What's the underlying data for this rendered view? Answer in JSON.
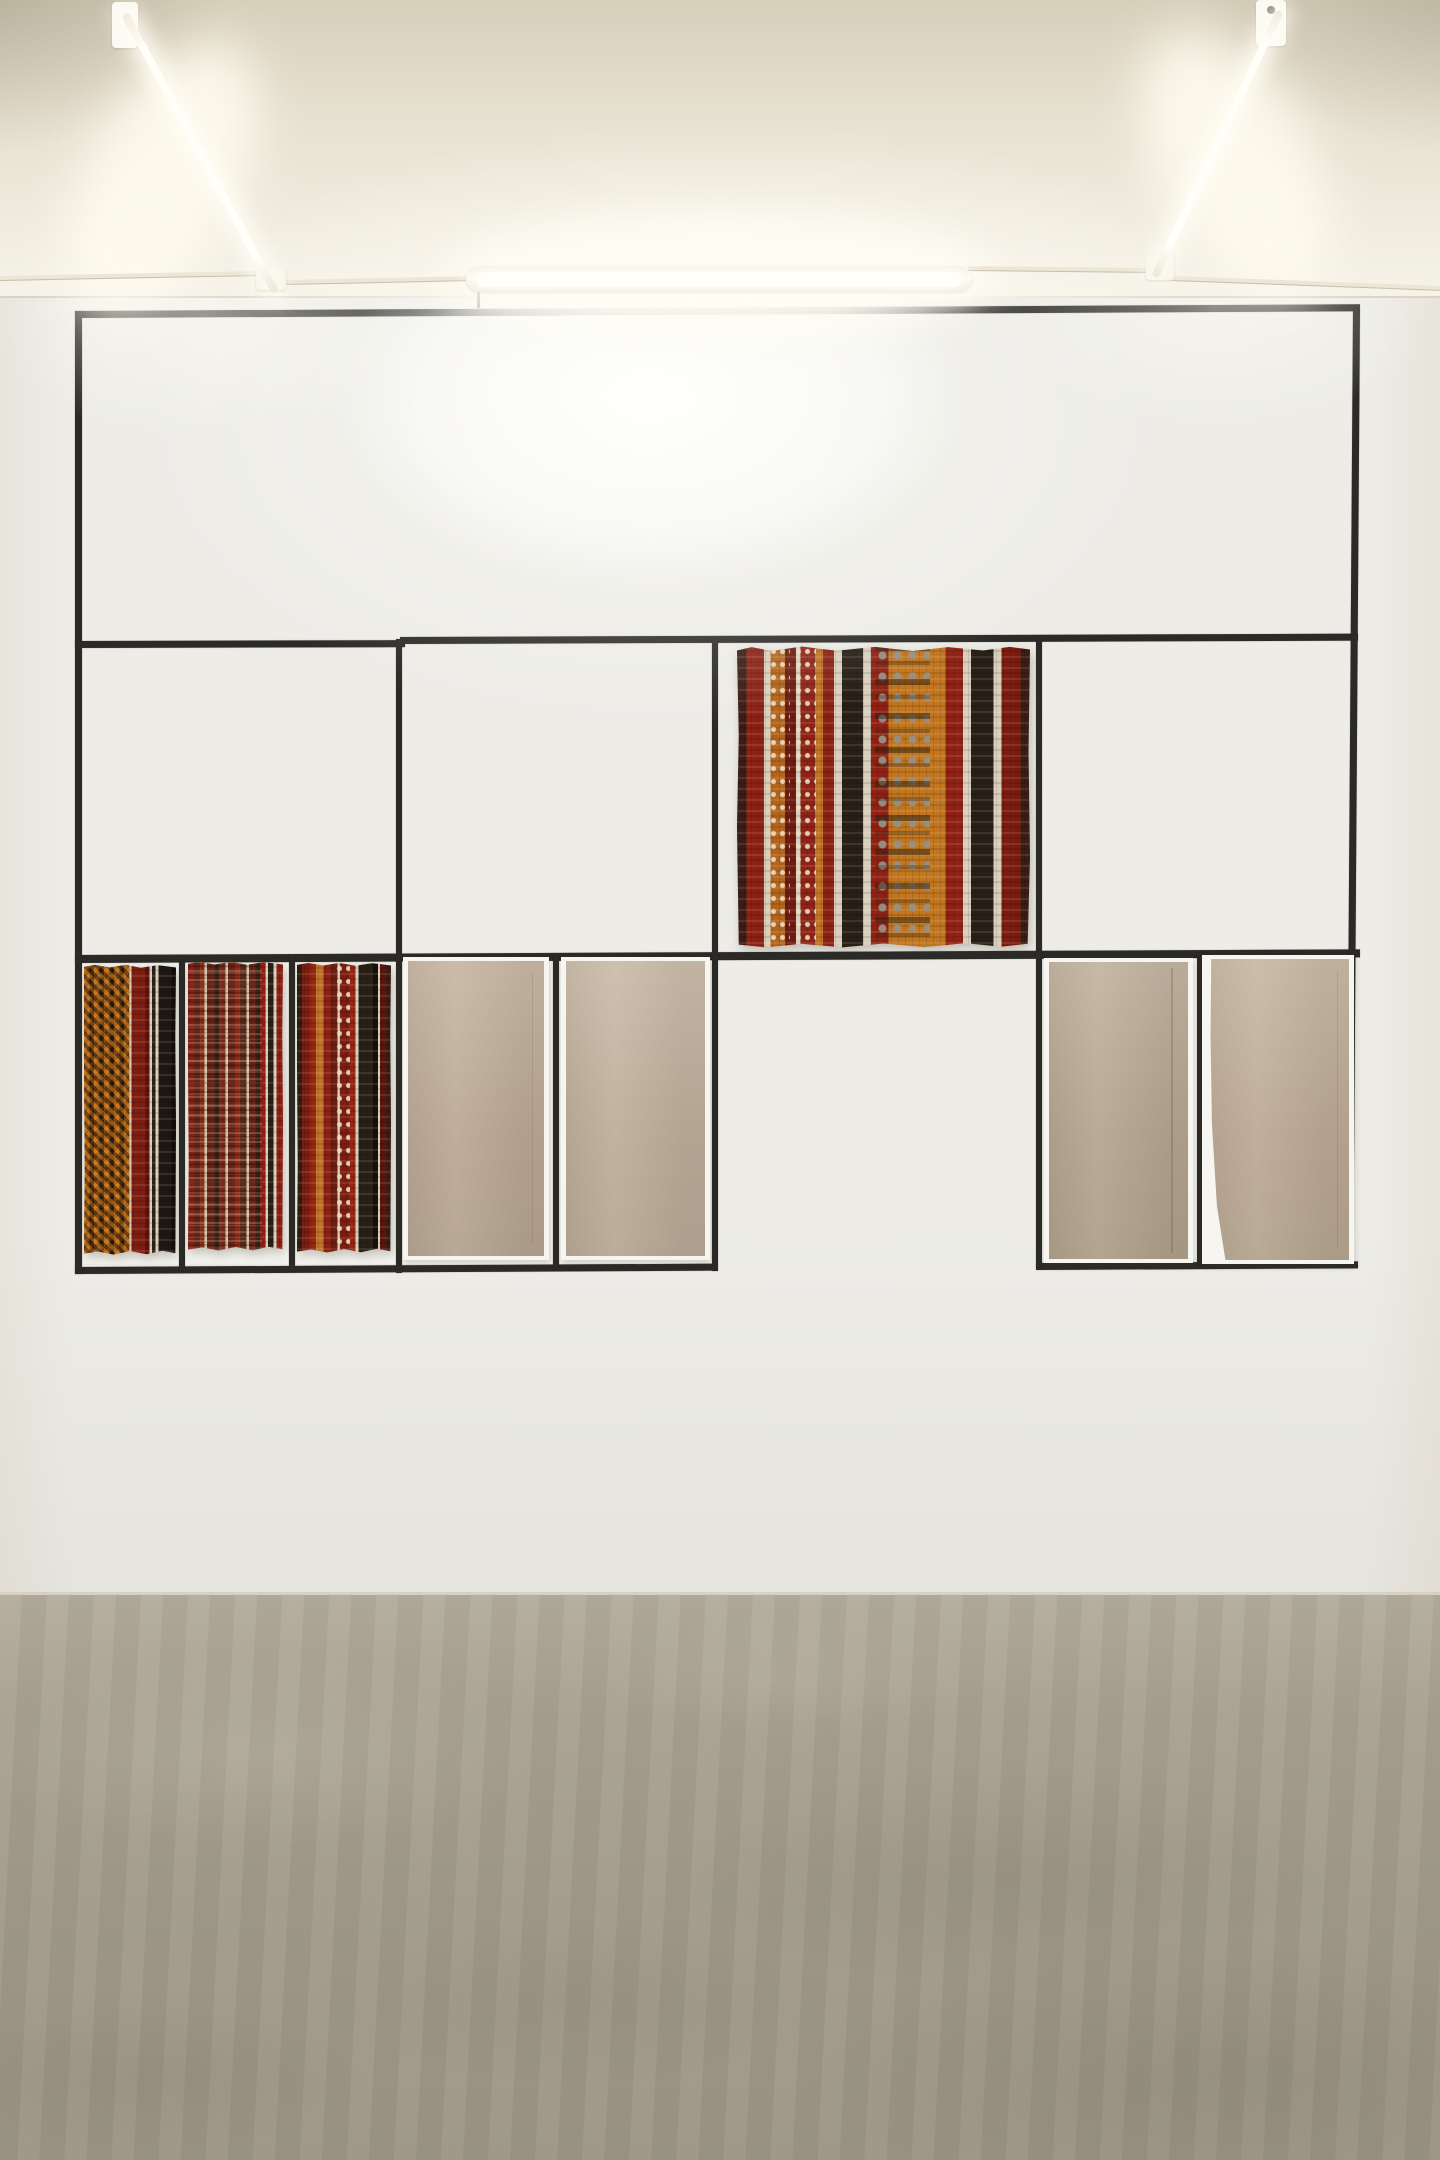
{
  "meta": {
    "description": "Gallery installation photograph: a hand-taped black grid on a white wall displaying striped woven textiles and plain beige canvas panels, lit by fluorescent tubes, above a raw concrete floor",
    "visible_text": []
  },
  "palette": {
    "wall": "#edece7",
    "cell": "#f2f1ec",
    "tape": "#2b2a26",
    "paper": "#f7f5ef",
    "ceiling-top": "#d7cfba",
    "ceiling-bottom": "#f6f3e9",
    "glow": "#fffdf3",
    "floor": "#a8a192",
    "floor-light": "#b4ad9d",
    "floor-dark": "#9d9687"
  },
  "lighting": {
    "fixture_count": 3,
    "fixtures": [
      {
        "id": "tube-left",
        "type": "fluorescent-tube",
        "orientation": "diagonal"
      },
      {
        "id": "tube-center",
        "type": "fluorescent-tube",
        "orientation": "horizontal"
      },
      {
        "id": "tube-right",
        "type": "fluorescent-tube",
        "orientation": "diagonal"
      }
    ]
  },
  "grid": {
    "rows": 3,
    "row_contents": [
      "single full-width empty cell",
      "four cells, one hanging striped textile in third cell",
      "left box with five cells (three woven strips, two canvases), open middle gap, right box with two canvas cells"
    ]
  },
  "artworks": [
    {
      "id": "kilim-hanging",
      "label": "Hanging striped woven textile (red, orange, black ikat bands)",
      "stripes": [
        [
          "#3a1d15",
          3
        ],
        [
          "#8c2114",
          5.5
        ],
        [
          "#d9cebc",
          2
        ],
        [
          "#b3651d",
          4.5
        ],
        [
          "#6f1d10",
          3.5
        ],
        [
          "#d9cebc",
          1.5
        ],
        [
          "#8f2416",
          4.5
        ],
        [
          "#c07428",
          2.5
        ],
        [
          "#8c2114",
          3.5
        ],
        [
          "#d9cebc",
          2.5
        ],
        [
          "#282017",
          6.5
        ],
        [
          "#d9cebc",
          2.5
        ],
        [
          "#8f2214",
          5.5
        ],
        [
          "#c1761f",
          18
        ],
        [
          "#8f2214",
          5.5
        ],
        [
          "#d9cebc",
          2.5
        ],
        [
          "#282017",
          7
        ],
        [
          "#d9cebc",
          2.5
        ],
        [
          "#7c1c10",
          6
        ],
        [
          "#3a1d15",
          3
        ]
      ]
    },
    {
      "id": "strip-1",
      "label": "Woven strip with orange diamond lattice, dark red band and black edge",
      "stripes": [
        [
          "#c4711c",
          5
        ],
        [
          "#2e1d10",
          4
        ],
        [
          "#c4711c",
          5
        ],
        [
          "#2e1d10",
          4
        ],
        [
          "#c4711c",
          5
        ],
        [
          "#2e1d10",
          4
        ],
        [
          "#c4711c",
          5
        ],
        [
          "#2e1d10",
          4
        ],
        [
          "#c4711c",
          5
        ],
        [
          "#d3c7b2",
          2
        ],
        [
          "#7e1d12",
          12
        ],
        [
          "#5f150c",
          4
        ],
        [
          "#d9cebc",
          2.5
        ],
        [
          "#2a211a",
          3
        ],
        [
          "#d9cebc",
          2.5
        ],
        [
          "#1f1812",
          12
        ],
        [
          "#120d09",
          4
        ]
      ]
    },
    {
      "id": "strip-2",
      "label": "Woven strip with fine red and maroon patterned bands",
      "stripes": [
        [
          "#8a2114",
          6
        ],
        [
          "#5f2a1a",
          5
        ],
        [
          "#93301b",
          4
        ],
        [
          "#d0c2ab",
          2
        ],
        [
          "#6b2517",
          7
        ],
        [
          "#3a2313",
          4
        ],
        [
          "#7c2b19",
          6
        ],
        [
          "#d0c2ab",
          2
        ],
        [
          "#6b2517",
          7
        ],
        [
          "#93301b",
          4
        ],
        [
          "#5f2a1a",
          6
        ],
        [
          "#d0c2ab",
          2
        ],
        [
          "#6b2517",
          6
        ],
        [
          "#3a2313",
          4
        ],
        [
          "#8a2114",
          5
        ],
        [
          "#d9cebc",
          2.5
        ],
        [
          "#2a1f16",
          5
        ],
        [
          "#d9cebc",
          2.5
        ],
        [
          "#8a2114",
          6
        ]
      ]
    },
    {
      "id": "strip-3",
      "label": "Woven strip with red and orange bands and wide black stripe",
      "stripes": [
        [
          "#2f1c12",
          4
        ],
        [
          "#7c1d10",
          7
        ],
        [
          "#962716",
          5
        ],
        [
          "#c07428",
          6
        ],
        [
          "#8c2114",
          6
        ],
        [
          "#6f1d10",
          6
        ],
        [
          "#d9cebc",
          2
        ],
        [
          "#7c1d10",
          8
        ],
        [
          "#962716",
          5
        ],
        [
          "#d9cebc",
          2.5
        ],
        [
          "#282017",
          12
        ],
        [
          "#17100c",
          4
        ],
        [
          "#d9cebc",
          2
        ],
        [
          "#5a150c",
          5
        ],
        [
          "#3a1d15",
          4
        ]
      ]
    },
    {
      "id": "canvas-1",
      "label": "Plain beige canvas panel",
      "fill": "#c2b09b"
    },
    {
      "id": "canvas-2",
      "label": "Plain beige canvas panel",
      "fill": "#c6b5a1"
    },
    {
      "id": "canvas-3",
      "label": "Plain beige canvas panel with crease",
      "fill": "#bdac97"
    },
    {
      "id": "canvas-4",
      "label": "Plain beige canvas panel with curved edge",
      "fill": "#c3b19c"
    }
  ]
}
